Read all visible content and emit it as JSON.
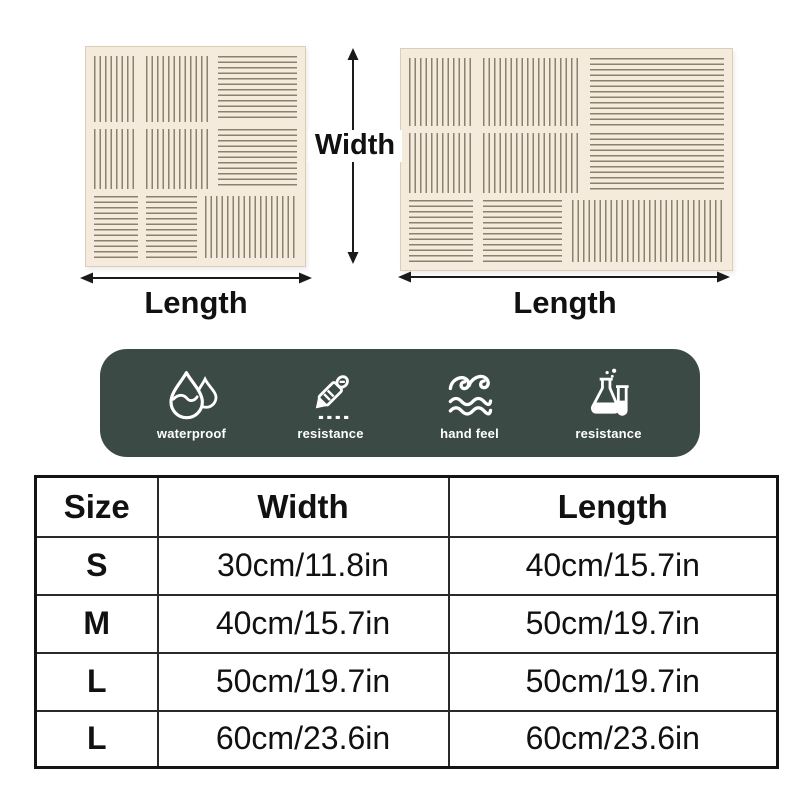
{
  "diagram": {
    "width_label": "Width",
    "length_label_left": "Length",
    "length_label_right": "Length",
    "mats": [
      {
        "name": "small square placemat",
        "pattern": "3x3 woven stripe blocks"
      },
      {
        "name": "large rectangular placemat",
        "pattern": "3x3 woven stripe blocks"
      }
    ]
  },
  "features": {
    "items": [
      {
        "icon": "waterproof-drop-icon",
        "label": "waterproof"
      },
      {
        "icon": "cutter-knife-icon",
        "label": "resistance"
      },
      {
        "icon": "wave-icon",
        "label": "hand feel"
      },
      {
        "icon": "chemical-flask-icon",
        "label": "resistance"
      }
    ]
  },
  "size_table": {
    "headers": [
      "Size",
      "Width",
      "Length"
    ],
    "rows": [
      {
        "size": "S",
        "width": "30cm/11.8in",
        "length": "40cm/15.7in"
      },
      {
        "size": "M",
        "width": "40cm/15.7in",
        "length": "50cm/19.7in"
      },
      {
        "size": "L",
        "width": "50cm/19.7in",
        "length": "50cm/19.7in"
      },
      {
        "size": "L",
        "width": "60cm/23.6in",
        "length": "60cm/23.6in"
      }
    ]
  },
  "colors": {
    "banner_background": "#3b4a45",
    "banner_text": "#ffffff",
    "mat_background": "#f5ebdd",
    "mat_stripe": "#8a8170",
    "table_border": "#1a1a1a",
    "page_background": "#ffffff"
  }
}
